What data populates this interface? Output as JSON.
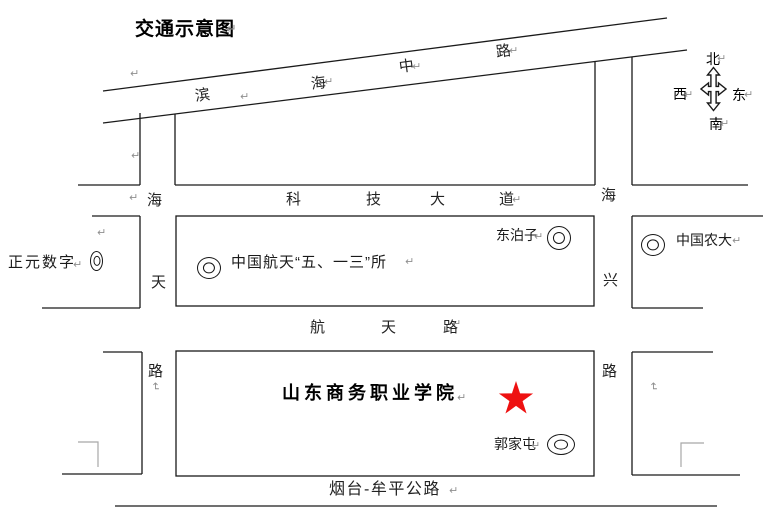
{
  "title": "交通示意图",
  "compass": {
    "north": "北",
    "west": "西",
    "east": "东",
    "south": "南"
  },
  "roads": {
    "binhai_middle_road": {
      "chars": [
        "滨",
        "海",
        "中",
        "路"
      ]
    },
    "keji_avenue": {
      "chars": [
        "科",
        "技",
        "大",
        "道"
      ]
    },
    "haitian_road": {
      "chars": [
        "海",
        "天",
        "路"
      ]
    },
    "haixing_road": {
      "chars": [
        "海",
        "兴",
        "路"
      ]
    },
    "hangtian_road": {
      "chars": [
        "航",
        "天",
        "路"
      ]
    },
    "yantai_muping_highway": "烟台-牟平公路"
  },
  "places": {
    "zhengyuan_digital": "正元数字",
    "casc_513_institute": "中国航天“五、一三”所",
    "dongbozi": "东泊子",
    "china_agricultural_univ": "中国农大",
    "college": "山东商务职业学院",
    "guojiatun": "郭家屯"
  },
  "marks": {
    "paragraph_return": "↵"
  },
  "colors": {
    "star_red": "#ee1111",
    "line_black": "#1a1a1a",
    "mark_gray": "#8f8f8f",
    "bracket_gray": "#a8a8a8"
  }
}
